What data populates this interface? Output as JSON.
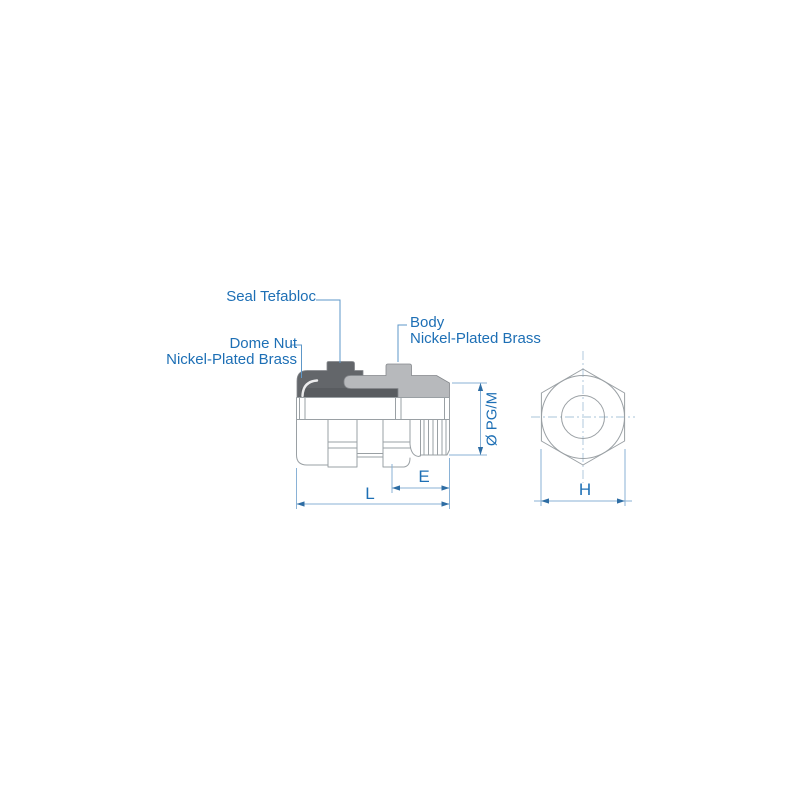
{
  "figure": {
    "callouts": {
      "seal": {
        "label": "Seal Tefabloc"
      },
      "dome_nut": {
        "line1": "Dome Nut",
        "line2": "Nickel-Plated Brass"
      },
      "body": {
        "line1": "Body",
        "line2": "Nickel-Plated Brass"
      }
    },
    "dimensions": {
      "thread_diameter": "Ø PG/M",
      "thread_length": "E",
      "overall_length": "L",
      "hex_across_flats": "H"
    },
    "colors": {
      "label_text": "#1d6fb5",
      "dimension_line": "#8ab2d6",
      "arrowhead": "#2e6da4",
      "leader_line": "#5d97c8",
      "part_outline": "#9aa0a4",
      "dome_nut_fill": "#63666a",
      "seal_fill": "#595c60",
      "body_fill": "#b7b9bc",
      "centerline": "#aac4da",
      "background": "#ffffff"
    }
  }
}
